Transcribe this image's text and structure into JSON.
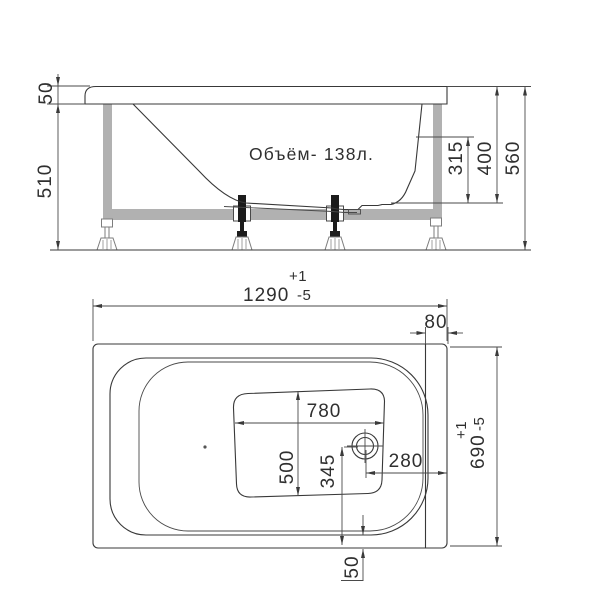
{
  "drawing": {
    "side_view": {
      "volume_label": "Объём- 138л.",
      "rim_height": "50",
      "stand_height": "510",
      "inner_depth": "315",
      "depth_to_bottom": "400",
      "total_height": "560"
    },
    "plan_view": {
      "length": "1290",
      "length_tol_plus": "+1",
      "length_tol_minus": "-5",
      "head_rim_width": "80",
      "width": "690",
      "width_tol_plus": "+1",
      "width_tol_minus": "-5",
      "bottom_length": "780",
      "bottom_width": "500",
      "drain_to_end": "345",
      "drain_to_edge": "280",
      "foot_rim_width": "50"
    },
    "colors": {
      "line": "#383838",
      "frame_gray": "#b1b1b1",
      "background": "#ffffff"
    }
  }
}
